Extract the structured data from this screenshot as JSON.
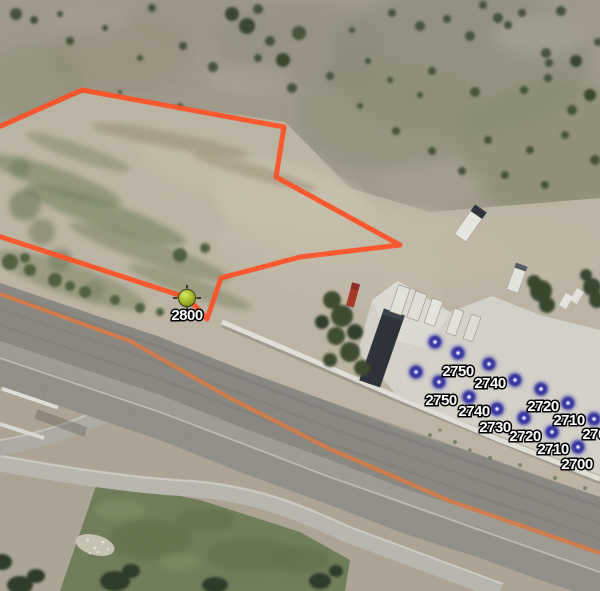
{
  "map_overlay": {
    "boundary_polygon": {
      "color": "#ff5126",
      "stroke_width": 5,
      "points": [
        [
          -8,
          130
        ],
        [
          82,
          90
        ],
        [
          284,
          127
        ],
        [
          276,
          177
        ],
        [
          400,
          245
        ],
        [
          300,
          257
        ],
        [
          221,
          278
        ],
        [
          207,
          319
        ],
        [
          188,
          298
        ],
        [
          -8,
          234
        ]
      ]
    },
    "elevation_point": {
      "label": "2800",
      "x": 187,
      "y": 298,
      "color": "#a9c02c",
      "label_dy": 17
    },
    "spray_color": "#3232a2",
    "spray_points": [
      {
        "x": 435,
        "y": 342
      },
      {
        "x": 458,
        "y": 353
      },
      {
        "x": 416,
        "y": 372
      },
      {
        "x": 439,
        "y": 382
      },
      {
        "x": 489,
        "y": 364
      },
      {
        "x": 515,
        "y": 380
      },
      {
        "x": 469,
        "y": 397
      },
      {
        "x": 541,
        "y": 389
      },
      {
        "x": 497,
        "y": 409
      },
      {
        "x": 568,
        "y": 403
      },
      {
        "x": 524,
        "y": 418
      },
      {
        "x": 594,
        "y": 419
      },
      {
        "x": 552,
        "y": 432
      },
      {
        "x": 578,
        "y": 447
      }
    ],
    "elevation_labels": [
      {
        "text": "2750",
        "x": 458,
        "y": 371
      },
      {
        "text": "2740",
        "x": 490,
        "y": 383
      },
      {
        "text": "2750",
        "x": 441,
        "y": 400
      },
      {
        "text": "2740",
        "x": 474,
        "y": 411
      },
      {
        "text": "2720",
        "x": 543,
        "y": 406
      },
      {
        "text": "2730",
        "x": 495,
        "y": 427
      },
      {
        "text": "2710",
        "x": 569,
        "y": 420
      },
      {
        "text": "2720",
        "x": 525,
        "y": 436
      },
      {
        "text": "2700",
        "x": 598,
        "y": 434
      },
      {
        "text": "2710",
        "x": 553,
        "y": 449
      },
      {
        "text": "2700",
        "x": 577,
        "y": 464
      }
    ]
  }
}
